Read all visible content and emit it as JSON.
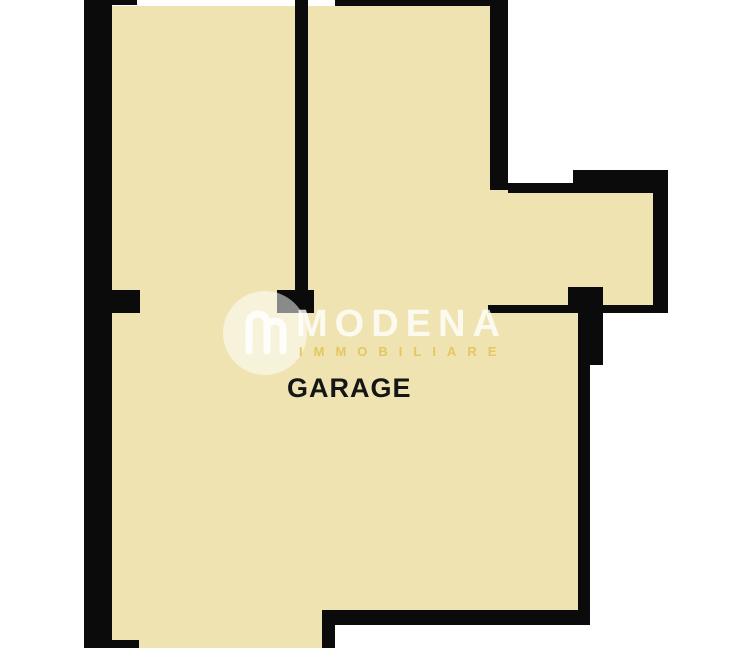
{
  "floorplan": {
    "room_label": "GARAGE",
    "watermark": {
      "brand": "MODENA",
      "subtitle": "IMMOBILIARE",
      "mark": "m-logo-icon"
    },
    "colors": {
      "background": "#ffffff",
      "floor_fill": "#efe3b1",
      "wall": "#0b0b0b",
      "watermark_white": "rgba(255,255,255,0.8)",
      "watermark_gold": "#e3c55c",
      "label_text": "#151515"
    }
  }
}
